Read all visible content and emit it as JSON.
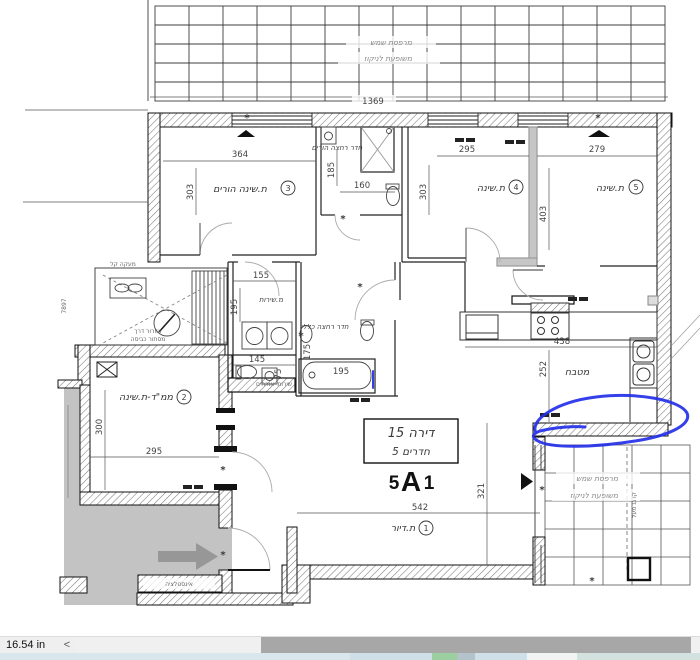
{
  "status_bar": {
    "measurement": "16.54 in",
    "left_arrow": "<"
  },
  "unit": {
    "box_title": "דירה 15",
    "box_subtitle": "5 חדרים",
    "code_size": "5",
    "code_letter": "A",
    "code_variant": "1"
  },
  "rooms": {
    "living": {
      "label": "ת.דיור",
      "num": "1"
    },
    "mamad": {
      "label": "ממ\"ד-ת.שינה",
      "num": "2"
    },
    "parents_bedroom": {
      "label": "ת.שינה הורים",
      "num": "3"
    },
    "bedroom_4": {
      "label": "ת.שינה",
      "num": "4"
    },
    "bedroom_5": {
      "label": "ת.שינה",
      "num": "5"
    },
    "parents_bath": {
      "label": "חדר רחצה הורים"
    },
    "family_bath": {
      "label": "חדר רחצה כללי"
    },
    "service_room": {
      "label": "מ.שירות"
    },
    "guest_wc": {
      "label": "שירותי אורחים"
    },
    "kitchen": {
      "label": "מטבח"
    },
    "terrace": {
      "line1": "מרפסת שמש",
      "line2": "משופעת לניקוז"
    },
    "pergola": {
      "line1": "מרפסת שמש",
      "line2": "משופעת לניקוז"
    }
  },
  "notes": {
    "light_railing": "מעקה קל",
    "vent_line1": "אוורור דרך",
    "vent_line2": "מסתור כביסה",
    "installation": "אינסטלציה",
    "roof_line": "קו גג מעל",
    "left_ref": "7897"
  },
  "dims": {
    "pergola_width": "1369",
    "r3_w": "364",
    "r3_h": "303",
    "pbath_h": "185",
    "pbath_w": "160",
    "r4_w": "295",
    "r4_h": "303",
    "r5_w": "279",
    "r5_h": "403",
    "service_w": "155",
    "service_h": "195",
    "guest_w": "145",
    "guest_h": "75",
    "tub_w": "195",
    "fbath_h": "175",
    "kitchen_w": "438",
    "kitchen_h": "252",
    "mamad_w": "295",
    "mamad_h": "300",
    "living_w": "542",
    "living_h": "321"
  },
  "colors": {
    "annotation_blue": "#2430e8"
  }
}
